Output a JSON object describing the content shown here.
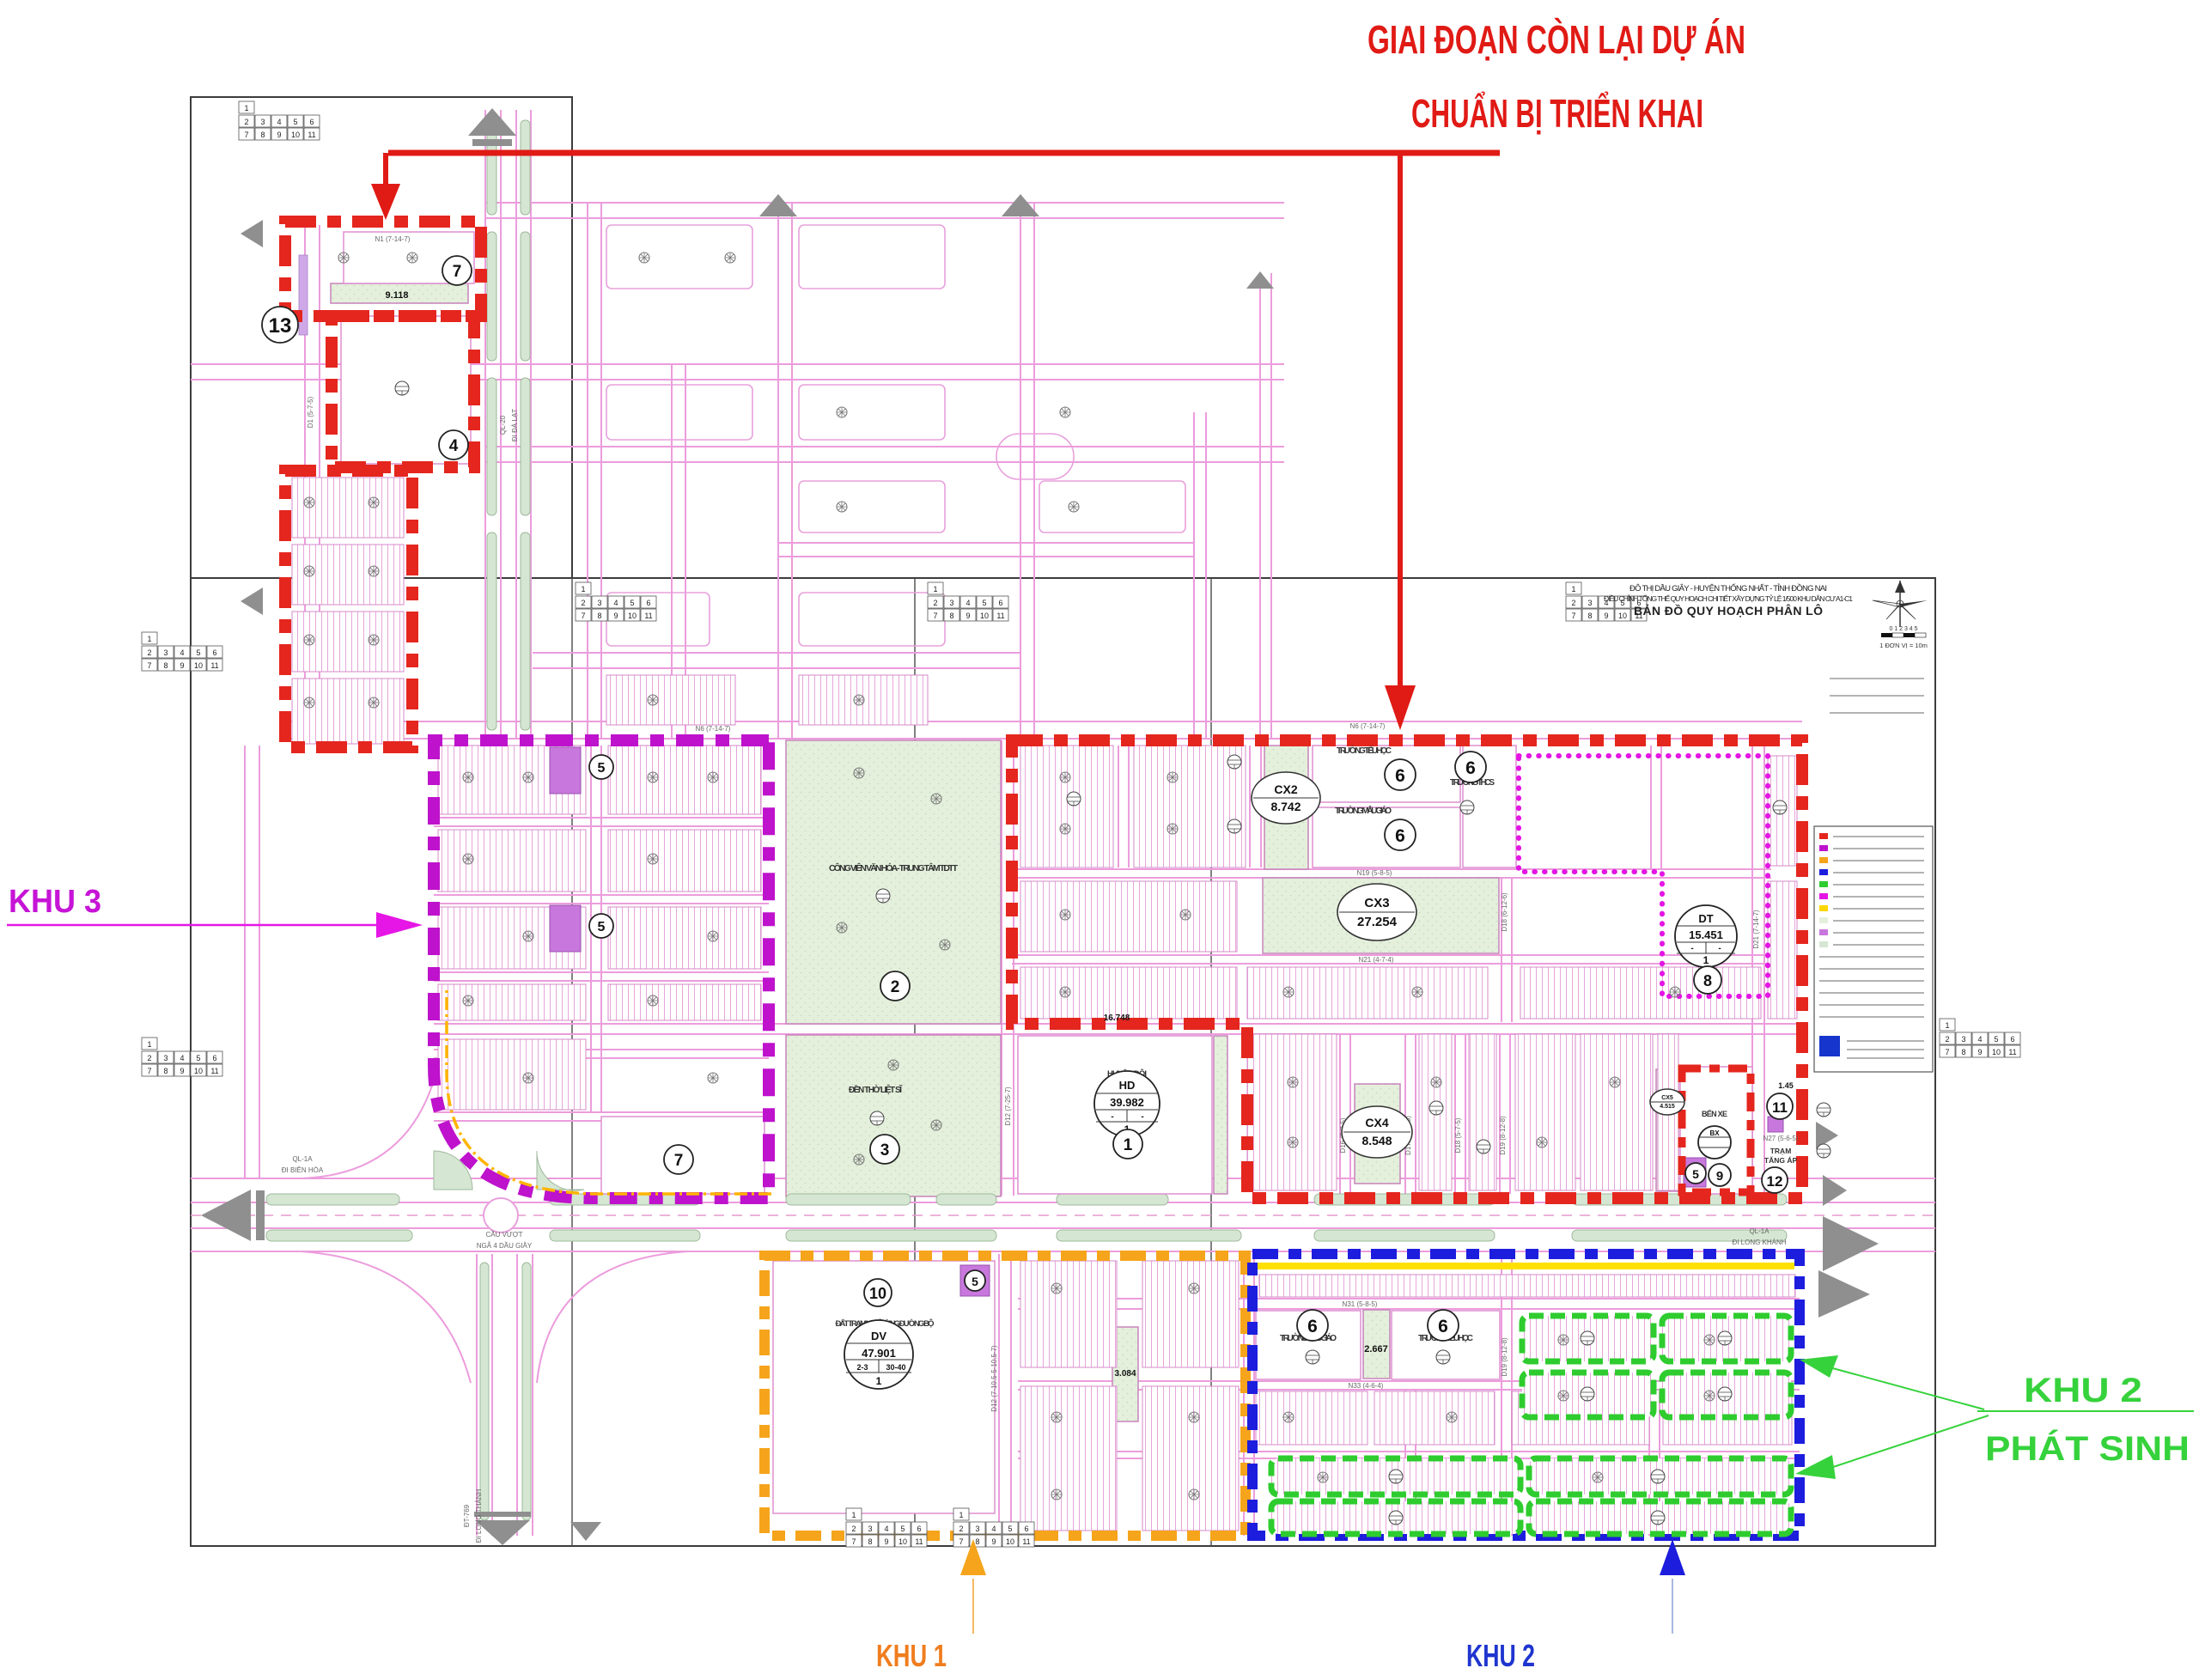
{
  "annotation": {
    "title1": "GIAI ĐOẠN CÒN LẠI DỰ ÁN",
    "title2": "CHUẨN BỊ TRIỂN KHAI",
    "khu3": "KHU 3",
    "khu1": "KHU 1",
    "khu2": "KHU 2",
    "khu2ps1": "KHU 2",
    "khu2ps2": "PHÁT SINH",
    "title_color": "#E01A15",
    "khu3_color": "#C614D6",
    "khu1_color": "#F07D1E",
    "khu2_color": "#1F35CF",
    "khu2ps_color": "#36D23C"
  },
  "title_block": {
    "line1": "ĐÔ THỊ DẦU GIÂY - HUYỆN THỐNG NHẤT - TỈNH ĐỒNG NAI",
    "line2": "ĐIỀU CHỈNH TỔNG THỂ QUY HOẠCH CHI TIẾT XÂY DỰNG TỶ LỆ 1/500 KHU DÂN CƯ A1-C1",
    "line3": "BẢN ĐỒ QUY HOẠCH PHÂN LÔ",
    "scale_ticks": "0  1  2  3  4  5",
    "scale_note": "1 ĐƠN VỊ = 10m"
  },
  "roads": {
    "ql20_1": "QL-20",
    "ql20_2": "ĐI ĐÀ LẠT",
    "ql1aw_1": "QL-1A",
    "ql1aw_2": "ĐI BIÊN HÒA",
    "over_1": "CẦU VƯỢT",
    "over_2": "NGÃ 4 DẦU GIÂY",
    "ql1ae_1": "QL-1A",
    "ql1ae_2": "ĐI LONG KHÁNH",
    "dt769_1": "ĐT-769",
    "dt769_2": "ĐI LONG THÀNH"
  },
  "streets": {
    "n1": "N1 (7-14-7)",
    "n6a": "N6 (7-14-7)",
    "n6b": "N6 (7-14-7)",
    "n19": "N19 (5-8-5)",
    "n21": "N21 (4-7-4)",
    "n27": "N27 (5-6-5)",
    "n31": "N31 (5-8-5)",
    "n33": "N33 (4-6-4)",
    "d1": "D1 (5-7-5)",
    "d12a": "D12 (7-25-7)",
    "d12b": "D12 (7-10.5-5-10.5-7)",
    "d16": "D16 (5-7-5)",
    "d17a": "D17A (5-7-5)",
    "d18a": "D18 (6-12-6)",
    "d18b": "D18 (5-7-5)",
    "d19a": "D19 (8-12-8)",
    "d19b": "D19 (8-12-8)",
    "d21": "D21 (7-14-7)"
  },
  "facilities": {
    "park": "CÔNG VIÊN VĂN HÓA - TRUNG TÂM TDTT",
    "memorial": "ĐỀN THỜ LIỆT SĨ",
    "huyen_doi": "HUYỆN ĐỘI",
    "tieu_hoc_top": "TRƯỜNG TIỂU HỌC",
    "mau_giao_top": "TRƯỜNG MẪU GIÁO",
    "thcs": "TRƯỜNG THCS",
    "mau_giao_bot": "TRƯỜNG MẪU GIÁO",
    "tieu_hoc_bot": "TRƯỜNG TIỂU HỌC",
    "ben_xe": "BẾN XE",
    "tram1": "TRẠM",
    "tram2": "TĂNG ÁP",
    "rest_stop": "ĐẤT TRẠM NGHỈ DỪNG ĐƯỜNG BỘ"
  },
  "parcels": {
    "cx2c": "CX2",
    "cx2v": "8.742",
    "cx3c": "CX3",
    "cx3v": "27.254",
    "cx4c": "CX4",
    "cx4v": "8.548",
    "cx5c": "CX5",
    "cx5v": "4.515",
    "hdc": "HD",
    "hdv": "39.982",
    "hd3a": "-",
    "hd3b": "-",
    "hd4": "1",
    "dtc": "DT",
    "dtv": "15.451",
    "dt3a": "-",
    "dt3b": "-",
    "dt4": "1",
    "dvc": "DV",
    "dvv": "47.901",
    "dv3a": "2-3",
    "dv3b": "30-40",
    "dv4": "1",
    "bxc": "BX",
    "strip_a": "9.118",
    "strip_b": "2.667",
    "strip_c": "3.084",
    "dim_a": "16.748",
    "dim_b": "1.45"
  },
  "blocks": [
    "13",
    "7",
    "4",
    "5",
    "5",
    "7",
    "2",
    "3",
    "1",
    "6",
    "6",
    "6",
    "8",
    "5",
    "9",
    "11",
    "12",
    "10",
    "5",
    "6",
    "6"
  ],
  "itable": {
    "c1": "1",
    "r2": [
      "2",
      "3",
      "4",
      "5",
      "6"
    ],
    "r3": [
      "7",
      "8",
      "9",
      "10",
      "11"
    ]
  }
}
